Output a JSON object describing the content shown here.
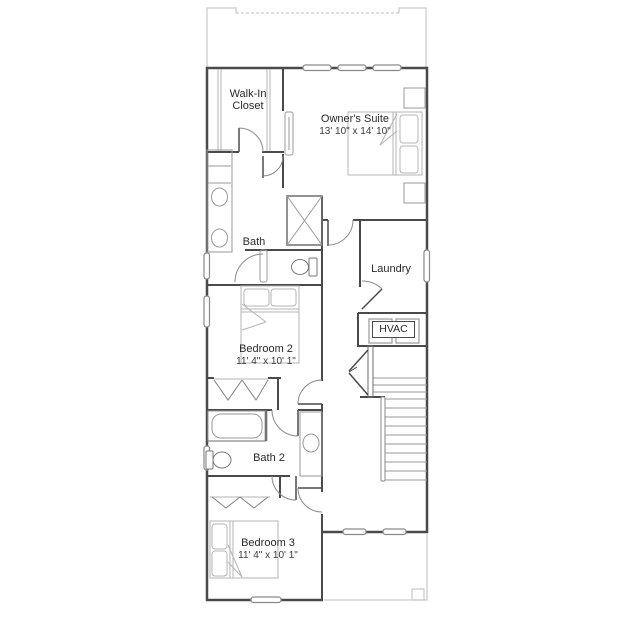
{
  "plan": {
    "rooms": {
      "walk_in_closet": {
        "name": "Walk-In Closet"
      },
      "owners_suite": {
        "name": "Owner's Suite",
        "dims": "13' 10\" x 14' 10\""
      },
      "bath": {
        "name": "Bath"
      },
      "laundry": {
        "name": "Laundry"
      },
      "hvac": {
        "name": "HVAC"
      },
      "bedroom_2": {
        "name": "Bedroom 2",
        "dims": "11' 4\" x 10' 1\""
      },
      "bath_2": {
        "name": "Bath 2"
      },
      "bedroom_3": {
        "name": "Bedroom 3",
        "dims": "11' 4\" x 10' 1\""
      }
    },
    "colors": {
      "wall": "#4a4a4a",
      "fixture": "#9a9a9a",
      "light_outline": "#c9c9c9",
      "text": "#2a2a2a",
      "background": "#ffffff"
    }
  }
}
